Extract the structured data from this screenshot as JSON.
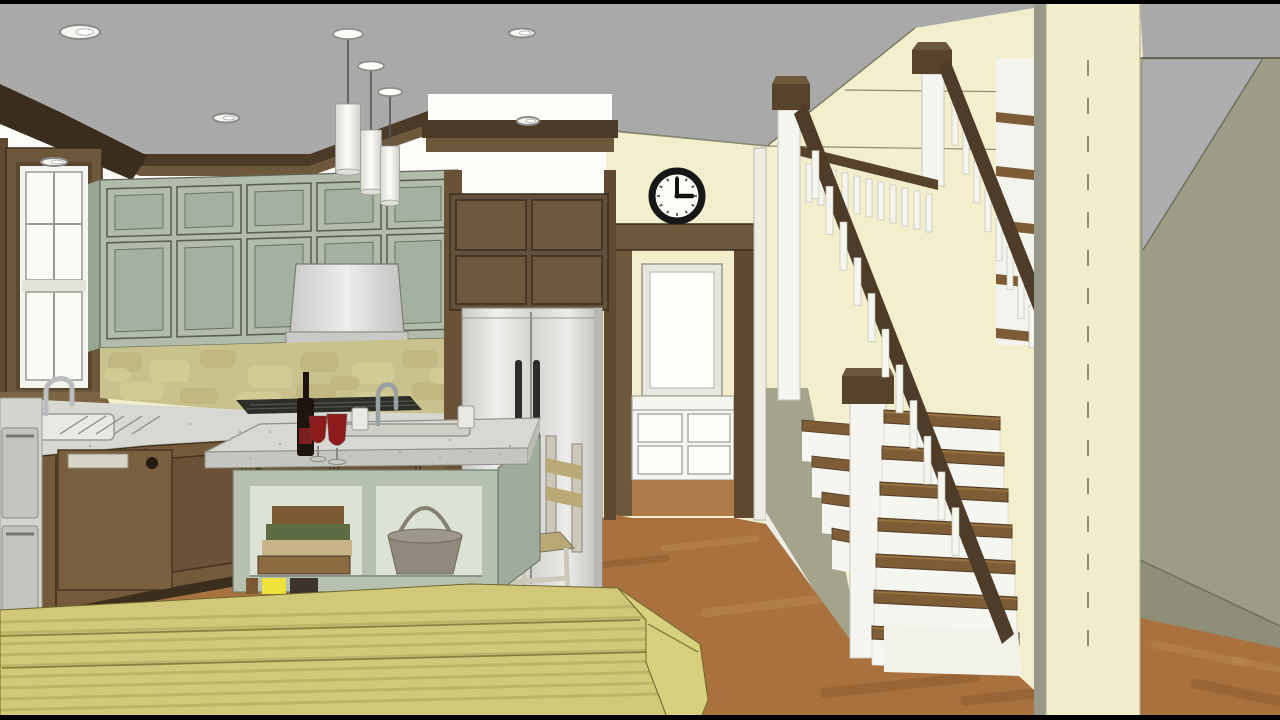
{
  "meta": {
    "type": "3d-interior-rendering",
    "style": "sketchup-linework",
    "description": "Open-plan craftsman kitchen rendering: sage upper cabinets, brown lower cabinets, stainless fridge and hood, kitchen island with books, basket, wine bottle and two wine glasses, doorway to mudroom, U-shaped staircase with wood treads and white risers, wood floor, yellow sofa in foreground, structural column with dashed centerline"
  },
  "clock": {
    "time": "3:00",
    "location": "wall above doorway"
  },
  "counts": {
    "pendant_lights": 3,
    "recessed_ceiling_lights": 5,
    "bar_stools": 2,
    "wine_glasses": 2,
    "lower_stair_steps_visible": 7,
    "upper_cabinet_door_columns": 5
  },
  "palette": {
    "black_bar": "#000000",
    "ceiling": "#a9a9a9",
    "wall": "#f3efcd",
    "wall_right": "#9c9c87",
    "wall_right_dark": "#8e8e79",
    "wall_stair_side": "#a4a48d",
    "gray_triangle": "#aeaeb0",
    "column": "#f2eecb",
    "column_strip": "#97978a",
    "frieze": "#fcfcf9",
    "crown_dark": "#4a3a26",
    "wood_trim": "#6d583c",
    "wood_trim_dark": "#3a2d1e",
    "cabinet_sage": "#b2bcaa",
    "cabinet_sage_panel": "#a5b1a0",
    "cabinet_sage_side": "#99a591",
    "cabinet_brown": "#74593a",
    "cabinet_brown_panel": "#6b5236",
    "cabinet_brown_dark": "#5f4a31",
    "overfridge_cabinet": "#63503a",
    "backsplash": "#c9c28c",
    "counter": "#d8d8d3",
    "counter_edge": "#a8a8a0",
    "island_base": "#b6c1af",
    "island_side": "#9fab9c",
    "island_interior": "#dde2d6",
    "floor": "#a8713e",
    "floor_dark": "#8a5a2d",
    "floor_light": "#bd8a52",
    "tread": "#7e5c35",
    "tread_light": "#96713f",
    "rail": "#4f3c28",
    "rail_mid": "#57432c",
    "step_white": "#f6f6f0",
    "stainless_dark": "#b8b8b4",
    "fridge_handle": "#2c2c2c",
    "sofa": "#d2c978",
    "sofa_arm": "#d9d07e",
    "sofa_seam": "#8a8140",
    "stool_wood": "#b9a977",
    "stool_frame": "#cdc8ba",
    "wine": "#8e1b1b",
    "bottle": "#1d1410",
    "basket": "#8f8a7b",
    "book_brown": "#7b5a33",
    "book_green": "#5d6b42",
    "book_tan": "#c9b48a",
    "book_yellow": "#f0e23a",
    "book_dark": "#3a342c",
    "clock_ring": "#171717",
    "clock_face": "#fdfdf8"
  },
  "scene": {
    "objects": [
      {
        "name": "ceiling",
        "label": "gray ceiling with recessed lights"
      },
      {
        "name": "pendant-lights",
        "label": "three white cylinder pendants over island"
      },
      {
        "name": "window",
        "label": "double-hung window over sink, wood casing"
      },
      {
        "name": "upper-cabinets",
        "label": "sage green shaker uppers, two rows"
      },
      {
        "name": "range-hood",
        "label": "stainless chimney hood"
      },
      {
        "name": "backsplash",
        "label": "mottled olive tile backsplash"
      },
      {
        "name": "sink-faucet",
        "label": "gooseneck faucet and sink"
      },
      {
        "name": "cooktop",
        "label": "dark cooktop under hood"
      },
      {
        "name": "lower-cabinets",
        "label": "brown base cabinets with dishwasher"
      },
      {
        "name": "wall-ovens",
        "label": "stainless wall appliances far left"
      },
      {
        "name": "refrigerator",
        "label": "stainless french-door fridge with cabinet over"
      },
      {
        "name": "wall-clock",
        "label": "black-rim wall clock reading 3:00"
      },
      {
        "name": "doorway",
        "label": "cased opening to mudroom with window and white built-in"
      },
      {
        "name": "staircase",
        "label": "two-run stair, wood rails and treads, white risers and balusters"
      },
      {
        "name": "island",
        "label": "sage island, gray top, books, basket, wine bottle, two glasses, prep faucet, canisters"
      },
      {
        "name": "bar-stools",
        "label": "two ladder-back stools"
      },
      {
        "name": "sofa",
        "label": "yellow-khaki sofa back in foreground"
      },
      {
        "name": "column",
        "label": "cream structural post with dashed centerline"
      },
      {
        "name": "wood-floor",
        "label": "medium oak plank floor"
      }
    ]
  }
}
